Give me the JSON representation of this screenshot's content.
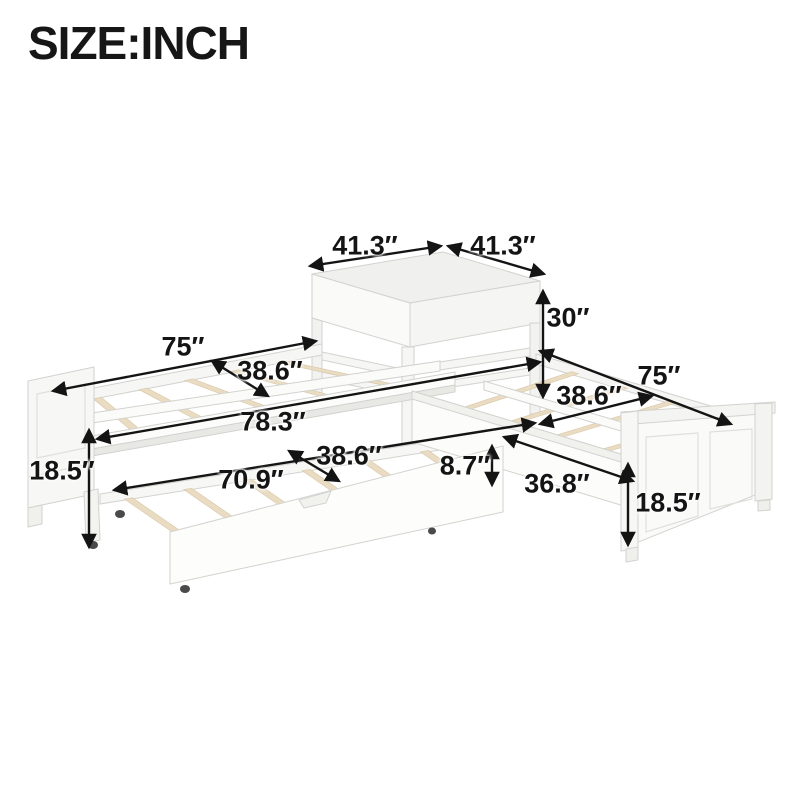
{
  "title": "SIZE:INCH",
  "unit": "inch",
  "dimensions": {
    "table_top_left": "41.3″",
    "table_top_right": "41.3″",
    "table_height": "30″",
    "left_bed_length": "75″",
    "left_bed_width": "38.6″",
    "overall_length": "78.3″",
    "left_bed_height": "18.5″",
    "trundle_length": "70.9″",
    "trundle_width": "38.6″",
    "trundle_height": "8.7″",
    "footboard_width": "36.8″",
    "right_bed_length": "75″",
    "right_bed_width": "38.6″",
    "right_bed_height": "18.5″"
  },
  "colors": {
    "background": "#ffffff",
    "text": "#141414",
    "bed_white": "#f7f7f5",
    "slat_wood": "#e9dcc3",
    "outline": "#d2d2cf"
  }
}
